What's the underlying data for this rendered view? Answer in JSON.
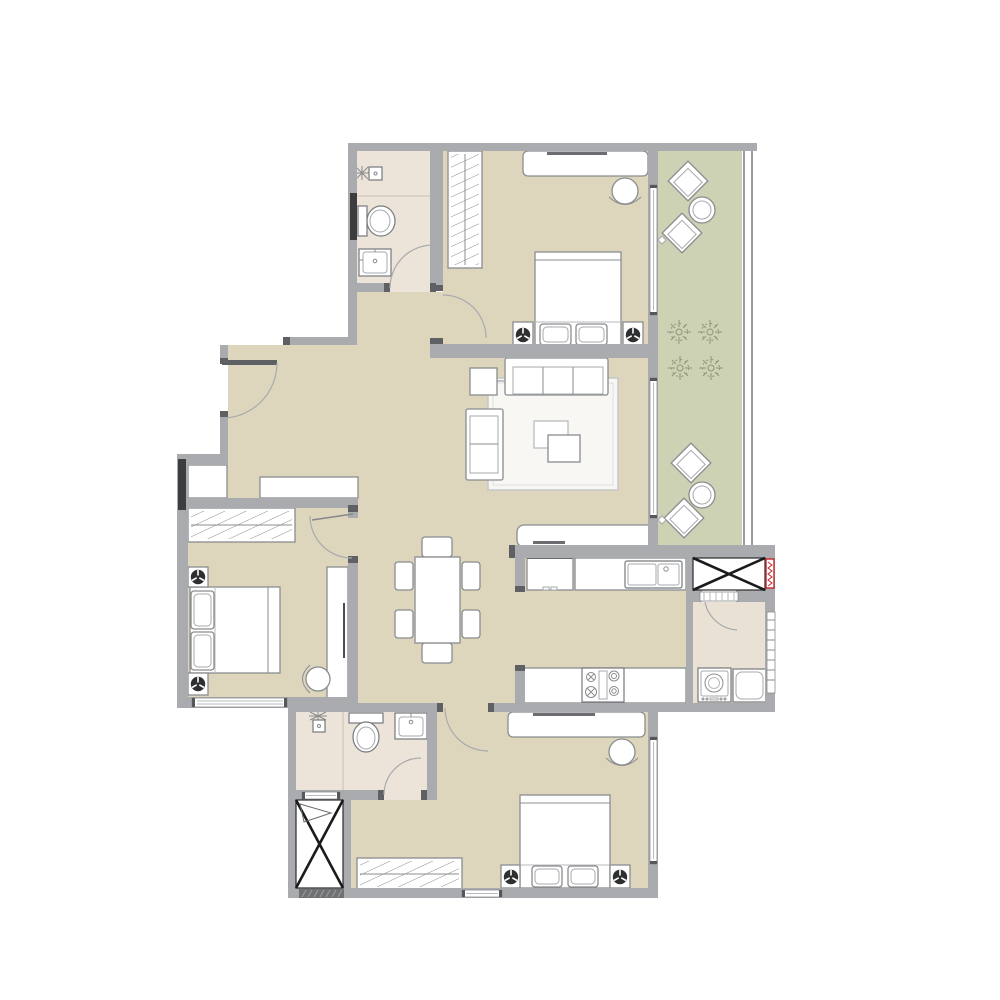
{
  "meta": {
    "type": "apartment-floor-plan",
    "canvas_width": 1000,
    "canvas_height": 1000
  },
  "colors": {
    "background": "#ffffff",
    "wall": "#a9abae",
    "wall_dark": "#5e6063",
    "floor_main": "#ddd6bd",
    "floor_bath": "#ece4d8",
    "floor_utility": "#e9e1d4",
    "floor_balcony": "#ccd2b3",
    "furniture_fill": "#ffffff",
    "furniture_stroke": "#8a8c8f",
    "shaft_line": "#1b1b1d",
    "marker_red": "#c3272b",
    "window_dark": "#3c3d3f",
    "hatch_line": "#8a8c8f",
    "lamp_dark": "#2e2f31",
    "plant_stroke": "#8f947c",
    "rug_fill": "#f8f7f3",
    "rug_stroke": "#c5c7c9"
  },
  "plan": {
    "rooms": [
      {
        "id": "entry-hall",
        "items": [
          "entry-door",
          "bench",
          "closet"
        ]
      },
      {
        "id": "bathroom-top",
        "items": [
          "shower-head",
          "toilet",
          "vanity-sink",
          "window",
          "swing-door"
        ]
      },
      {
        "id": "bedroom-top",
        "items": [
          "wardrobe",
          "desk",
          "desk-chair",
          "double-bed",
          "nightstand-left",
          "nightstand-right",
          "table-lamp-left",
          "table-lamp-right",
          "balcony-door",
          "swing-door"
        ]
      },
      {
        "id": "balcony",
        "items": [
          "lounge-chair",
          "lounge-chair",
          "round-table",
          "plant",
          "plant",
          "plant",
          "plant",
          "lounge-chair",
          "lounge-chair",
          "round-table",
          "railing"
        ]
      },
      {
        "id": "living-room",
        "items": [
          "sofa-three-seat",
          "sofa-two-seat",
          "side-table",
          "coffee-table",
          "coffee-table",
          "rug",
          "tv-cabinet",
          "window"
        ]
      },
      {
        "id": "dining-area",
        "items": [
          "dining-table",
          "dining-chair",
          "dining-chair",
          "dining-chair",
          "dining-chair",
          "dining-chair",
          "dining-chair"
        ]
      },
      {
        "id": "bedroom-left",
        "items": [
          "wardrobe",
          "double-bed",
          "nightstand-top",
          "nightstand-bottom",
          "table-lamp",
          "table-lamp",
          "desk",
          "desk-chair",
          "window",
          "swing-door"
        ]
      },
      {
        "id": "kitchen",
        "items": [
          "fridge",
          "counter-top",
          "double-sink",
          "counter-bottom",
          "cooktop-four-burner"
        ]
      },
      {
        "id": "utility-room",
        "items": [
          "washing-machine",
          "laundry-sink",
          "louver-door",
          "window"
        ]
      },
      {
        "id": "duct-shaft-top",
        "items": [
          "cross-brace",
          "riser-marker-red"
        ]
      },
      {
        "id": "bathroom-bottom",
        "items": [
          "shower-head",
          "toilet",
          "vanity-sink",
          "vent-window",
          "swing-door"
        ]
      },
      {
        "id": "duct-shaft-bottom",
        "items": [
          "cross-brace",
          "vent-grille",
          "flag-mark"
        ]
      },
      {
        "id": "bedroom-bottom",
        "items": [
          "wardrobe",
          "double-bed",
          "nightstand-left",
          "nightstand-right",
          "table-lamp",
          "table-lamp",
          "desk",
          "desk-chair",
          "window-right",
          "window-bottom",
          "swing-door"
        ]
      }
    ]
  }
}
